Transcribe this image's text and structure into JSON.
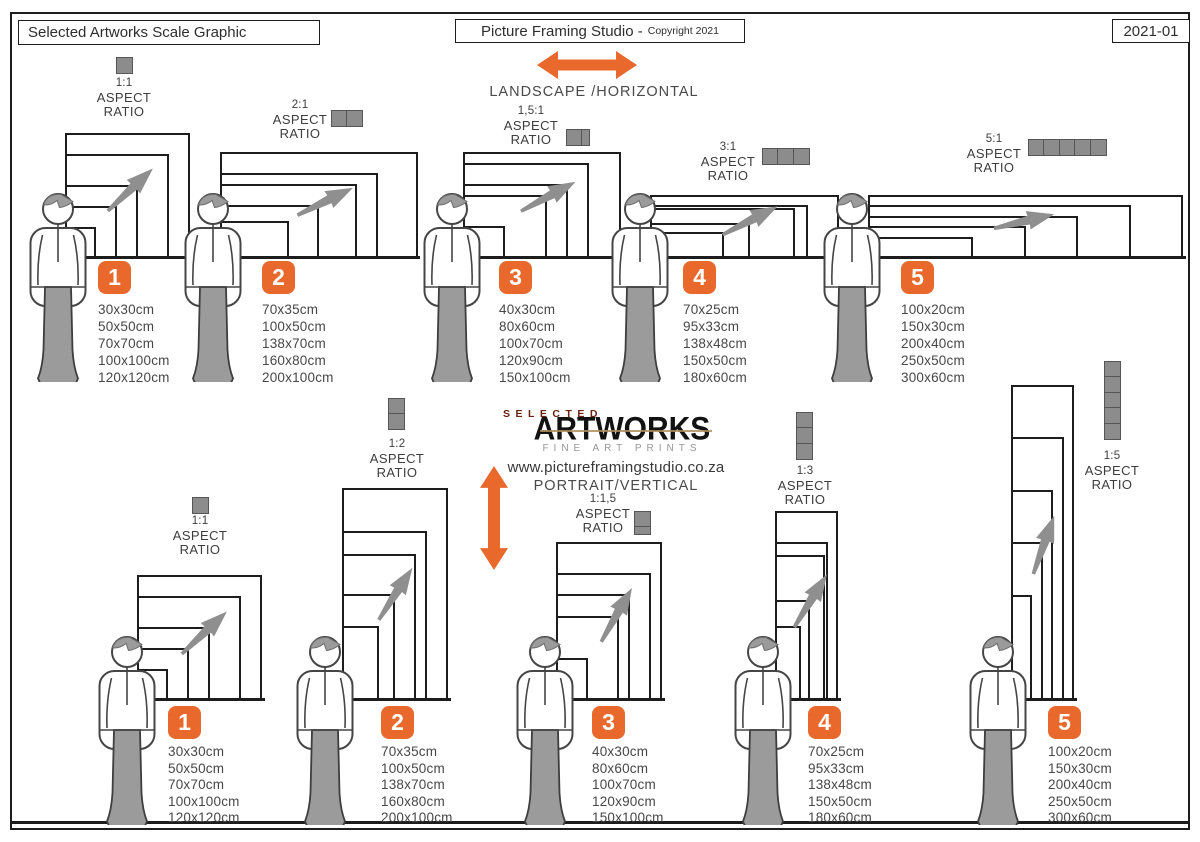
{
  "header": {
    "left_title": "Selected Artworks Scale Graphic",
    "studio_title": "Picture Framing Studio -",
    "copyright": "Copyright 2021",
    "edition": "2021-01"
  },
  "labels": {
    "aspect": "ASPECT",
    "ratio": "RATIO"
  },
  "landscape": {
    "direction_label": "LANDSCAPE /HORIZONTAL",
    "groups": [
      {
        "number": "1",
        "ratio": "1:1",
        "squares": 1,
        "sizes": [
          "30x30cm",
          "50x50cm",
          "70x70cm",
          "100x100cm",
          "120x120cm"
        ]
      },
      {
        "number": "2",
        "ratio": "2:1",
        "squares": 2,
        "sizes": [
          "70x35cm",
          "100x50cm",
          "138x70cm",
          "160x80cm",
          "200x100cm"
        ]
      },
      {
        "number": "3",
        "ratio": "1,5:1",
        "squares": 1.5,
        "sizes": [
          "40x30cm",
          "80x60cm",
          "100x70cm",
          "120x90cm",
          "150x100cm"
        ]
      },
      {
        "number": "4",
        "ratio": "3:1",
        "squares": 3,
        "sizes": [
          "70x25cm",
          "95x33cm",
          "138x48cm",
          "150x50cm",
          "180x60cm"
        ]
      },
      {
        "number": "5",
        "ratio": "5:1",
        "squares": 5,
        "sizes": [
          "100x20cm",
          "150x30cm",
          "200x40cm",
          "250x50cm",
          "300x60cm"
        ]
      }
    ]
  },
  "portrait": {
    "direction_label": "PORTRAIT/VERTICAL",
    "website": "www.pictureframingstudio.co.za",
    "logo": {
      "selected": "SELECTED",
      "artworks": "ARTWORKS",
      "tagline": "FINE ART PRINTS"
    },
    "groups": [
      {
        "number": "1",
        "ratio": "1:1",
        "squares": 1,
        "sizes": [
          "30x30cm",
          "50x50cm",
          "70x70cm",
          "100x100cm",
          "120x120cm"
        ]
      },
      {
        "number": "2",
        "ratio": "1:2",
        "squares": 2,
        "sizes": [
          "70x35cm",
          "100x50cm",
          "138x70cm",
          "160x80cm",
          "200x100cm"
        ]
      },
      {
        "number": "3",
        "ratio": "1:1,5",
        "squares": 1.5,
        "sizes": [
          "40x30cm",
          "80x60cm",
          "100x70cm",
          "120x90cm",
          "150x100cm"
        ]
      },
      {
        "number": "4",
        "ratio": "1:3",
        "squares": 3,
        "sizes": [
          "70x25cm",
          "95x33cm",
          "138x48cm",
          "150x50cm",
          "180x60cm"
        ]
      },
      {
        "number": "5",
        "ratio": "1:5",
        "squares": 5,
        "sizes": [
          "100x20cm",
          "150x30cm",
          "200x40cm",
          "250x50cm",
          "300x60cm"
        ]
      }
    ]
  },
  "colors": {
    "accent_orange": "#E9682C",
    "icon_gray": "#8C8C8C",
    "figure_gray": "#9B9B9B",
    "line_black": "#1D1D1D",
    "logo_red": "#6D2113"
  }
}
